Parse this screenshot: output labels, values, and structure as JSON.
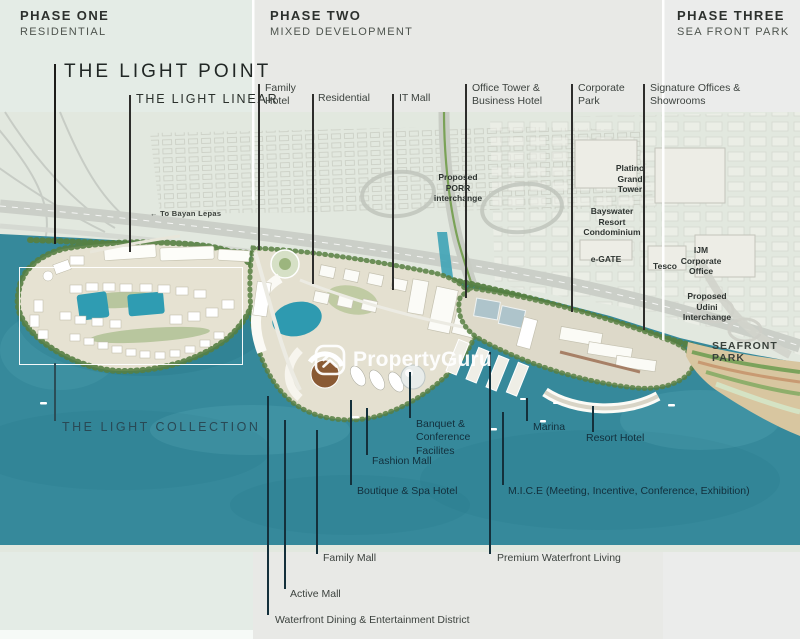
{
  "phases": [
    {
      "name": "PHASE ONE",
      "subtitle": "RESIDENTIAL"
    },
    {
      "name": "PHASE TWO",
      "subtitle": "MIXED DEVELOPMENT"
    },
    {
      "name": "PHASE THREE",
      "subtitle": "SEA FRONT PARK"
    }
  ],
  "light": {
    "point": "THE LIGHT POINT",
    "linear": "THE LIGHT LINEAR",
    "collection": "THE LIGHT COLLECTION"
  },
  "callouts_top": {
    "family_hotel": "Family\nHotel",
    "residential": "Residential",
    "it_mall": "IT Mall",
    "office_tower": "Office Tower &\nBusiness Hotel",
    "corporate_park": "Corporate\nPark",
    "signature_offices": "Signature Offices &\nShowrooms"
  },
  "water_labels": {
    "banquet": "Banquet &\nConference\nFacilites",
    "fashion_mall": "Fashion Mall",
    "marina": "Marina",
    "resort_hotel": "Resort Hotel",
    "boutique_spa": "Boutique & Spa Hotel",
    "mice": "M.I.C.E (Meeting, Incentive, Conference, Exhibition)"
  },
  "bottom_labels": {
    "family_mall": "Family Mall",
    "premium_waterfront": "Premium Waterfront Living",
    "active_mall": "Active Mall",
    "waterfront_dining": "Waterfront Dining & Entertainment District"
  },
  "city_labels": {
    "porr": "Proposed\nPORR\ninterchange",
    "platino": "Platino\nGrand\nTower",
    "bayswater": "Bayswater\nResort\nCondominium",
    "egate": "e-GATE",
    "tesco": "Tesco",
    "ijm": "IJM\nCorporate\nOffice",
    "udini": "Proposed\nUdini\nInterchange"
  },
  "seafront_park": "SEAFRONT PARK",
  "road_sign": "← To Bayan Lepas",
  "watermark": "PropertyGuru",
  "colors": {
    "water": "#36899B",
    "panel_green": "#E4ECE6",
    "panel_gray": "#E8E9E6",
    "label_dark": "#3C423E",
    "label_navy": "#122F3C"
  }
}
